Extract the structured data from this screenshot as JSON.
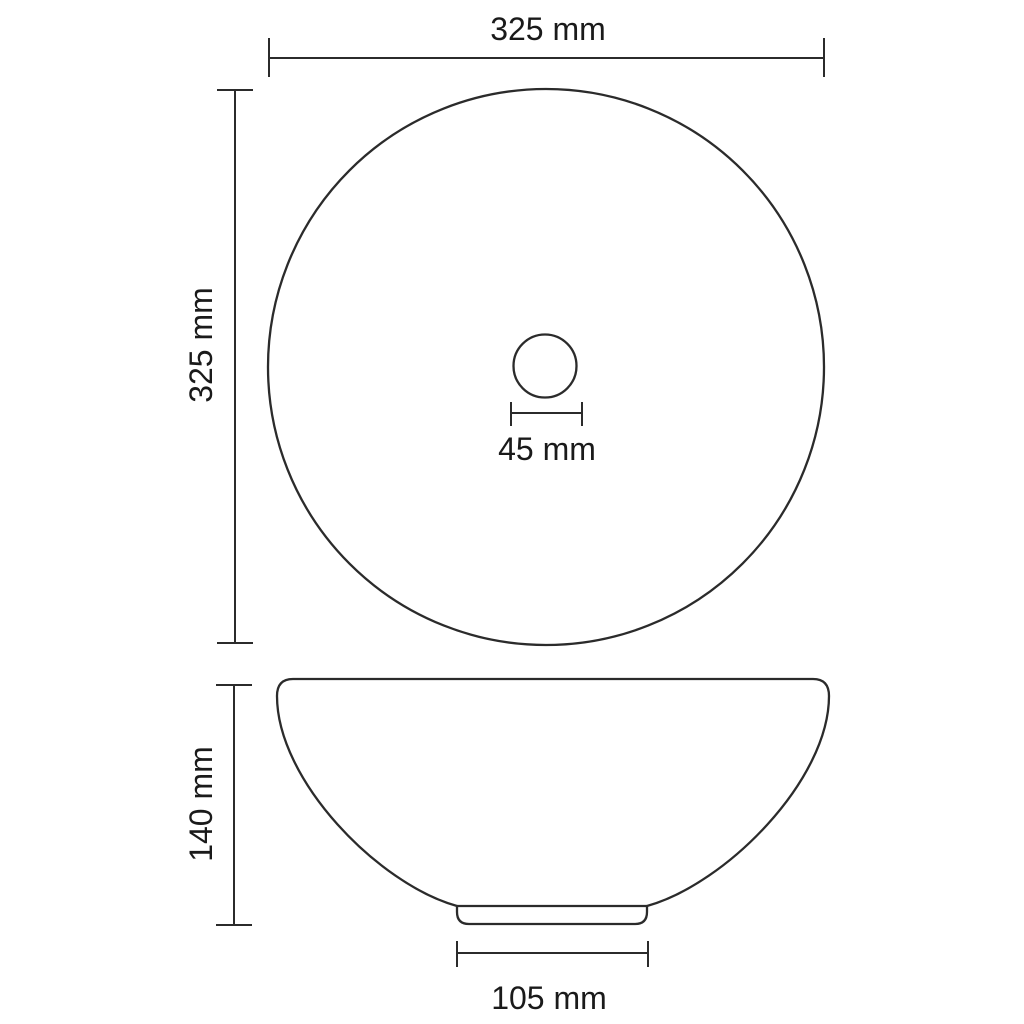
{
  "colors": {
    "background": "#ffffff",
    "line": "#2b2b2b",
    "text": "#1a1a1a"
  },
  "dimensions": {
    "top_width": "325 mm",
    "top_height": "325 mm",
    "drain_width": "45 mm",
    "side_height": "140 mm",
    "base_width": "105 mm"
  }
}
